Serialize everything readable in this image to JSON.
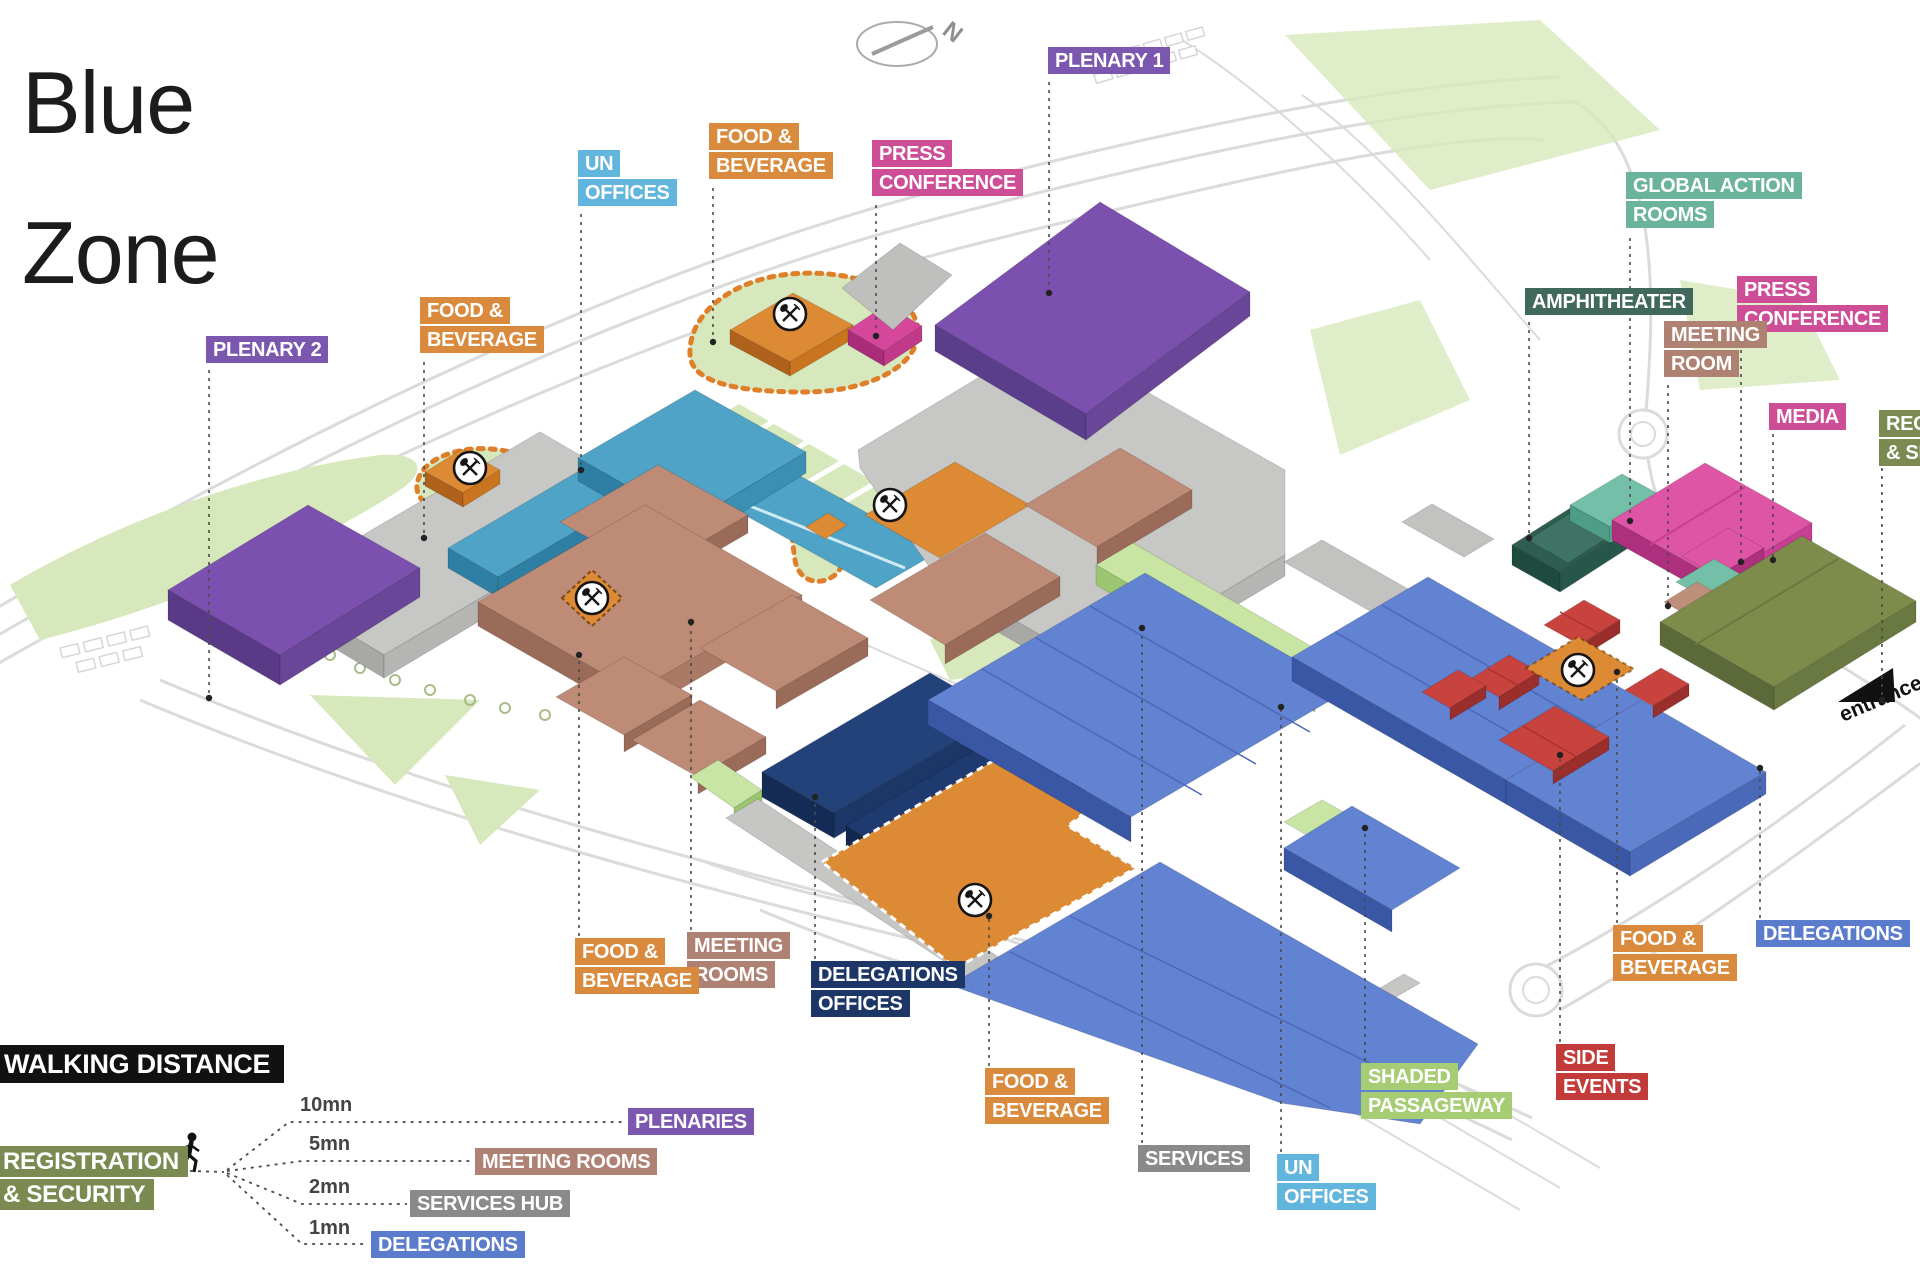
{
  "title": "Blue Zone",
  "map": {
    "compass_n": "N",
    "entrance_label": "entrance"
  },
  "colors": {
    "purple": "#7C57B0",
    "orange": "#D98A3D",
    "pink": "#CE4D97",
    "cyan": "#62B5DC",
    "teal": "#6CB39B",
    "darkgreen": "#40685C",
    "brown": "#AF8173",
    "olive": "#7A8A50",
    "navy": "#1C3667",
    "blue": "#5B7BCC",
    "lightgreen": "#A6CC74",
    "red": "#C23B38",
    "gray": "#8A8A8A",
    "black": "#111111"
  },
  "labels": [
    {
      "id": "plenary-1",
      "lines": [
        "PLENARY 1"
      ],
      "color": "purple",
      "x": 1048,
      "y": 47,
      "leader": {
        "x": 1049,
        "y1": 82,
        "y2": 293
      }
    },
    {
      "id": "un-offices-top",
      "lines": [
        "UN",
        "OFFICES"
      ],
      "color": "cyan",
      "x": 578,
      "y": 150,
      "leader": {
        "x": 581,
        "y1": 214,
        "y2": 470
      }
    },
    {
      "id": "food-beverage-top",
      "lines": [
        "FOOD &",
        "BEVERAGE"
      ],
      "color": "orange",
      "x": 709,
      "y": 123,
      "leader": {
        "x": 713,
        "y1": 188,
        "y2": 342
      }
    },
    {
      "id": "press-conference-top",
      "lines": [
        "PRESS",
        "CONFERENCE"
      ],
      "color": "pink",
      "x": 872,
      "y": 140,
      "leader": {
        "x": 876,
        "y1": 205,
        "y2": 336
      }
    },
    {
      "id": "food-beverage-left",
      "lines": [
        "FOOD &",
        "BEVERAGE"
      ],
      "color": "orange",
      "x": 420,
      "y": 297,
      "leader": {
        "x": 424,
        "y1": 362,
        "y2": 538
      }
    },
    {
      "id": "plenary-2",
      "lines": [
        "PLENARY 2"
      ],
      "color": "purple",
      "x": 206,
      "y": 336,
      "leader": {
        "x": 209,
        "y1": 370,
        "y2": 698
      }
    },
    {
      "id": "global-action-rooms",
      "lines": [
        "GLOBAL ACTION",
        "ROOMS"
      ],
      "color": "teal",
      "x": 1626,
      "y": 172,
      "leader": {
        "x": 1630,
        "y1": 238,
        "y2": 521
      }
    },
    {
      "id": "amphitheater",
      "lines": [
        "AMPHITHEATER"
      ],
      "color": "darkgreen",
      "x": 1525,
      "y": 288,
      "leader": {
        "x": 1529,
        "y1": 322,
        "y2": 538
      }
    },
    {
      "id": "press-conference-right",
      "lines": [
        "PRESS",
        "CONFERENCE"
      ],
      "color": "pink",
      "x": 1737,
      "y": 276,
      "leader": {
        "x": 1741,
        "y1": 342,
        "y2": 562
      }
    },
    {
      "id": "meeting-room-right",
      "lines": [
        "MEETING",
        "ROOM"
      ],
      "color": "brown",
      "x": 1664,
      "y": 321,
      "leader": {
        "x": 1668,
        "y1": 385,
        "y2": 606
      }
    },
    {
      "id": "media",
      "lines": [
        "MEDIA"
      ],
      "color": "pink",
      "x": 1769,
      "y": 403,
      "leader": {
        "x": 1773,
        "y1": 434,
        "y2": 560
      }
    },
    {
      "id": "registration-security-right",
      "lines": [
        "REGISTRATION",
        "& SECURITY"
      ],
      "color": "olive",
      "x": 1879,
      "y": 410,
      "leader": {
        "x": 1882,
        "y1": 468,
        "y2": 700
      }
    },
    {
      "id": "meeting-rooms-bottom",
      "lines": [
        "MEETING",
        "ROOMS"
      ],
      "color": "brown",
      "x": 687,
      "y": 932,
      "leader": {
        "x": 691,
        "y1": 930,
        "y2": 622
      }
    },
    {
      "id": "food-beverage-bottom-left",
      "lines": [
        "FOOD &",
        "BEVERAGE"
      ],
      "color": "orange",
      "x": 575,
      "y": 938,
      "leader": {
        "x": 579,
        "y1": 936,
        "y2": 655
      }
    },
    {
      "id": "delegations-offices",
      "lines": [
        "DELEGATIONS",
        "OFFICES"
      ],
      "color": "navy",
      "x": 811,
      "y": 961,
      "leader": {
        "x": 815,
        "y1": 959,
        "y2": 797
      }
    },
    {
      "id": "food-beverage-bottom-center",
      "lines": [
        "FOOD &",
        "BEVERAGE"
      ],
      "color": "orange",
      "x": 985,
      "y": 1068,
      "leader": {
        "x": 989,
        "y1": 1066,
        "y2": 916
      }
    },
    {
      "id": "services",
      "lines": [
        "SERVICES"
      ],
      "color": "gray",
      "x": 1138,
      "y": 1145,
      "leader": {
        "x": 1142,
        "y1": 1143,
        "y2": 628
      }
    },
    {
      "id": "un-offices-bottom",
      "lines": [
        "UN",
        "OFFICES"
      ],
      "color": "cyan",
      "x": 1277,
      "y": 1154,
      "leader": {
        "x": 1281,
        "y1": 1152,
        "y2": 707
      }
    },
    {
      "id": "shaded-passageway",
      "lines": [
        "SHADED",
        "PASSAGEWAY"
      ],
      "color": "lightgreen",
      "x": 1361,
      "y": 1063,
      "leader": {
        "x": 1365,
        "y1": 1061,
        "y2": 828
      }
    },
    {
      "id": "side-events",
      "lines": [
        "SIDE",
        "EVENTS"
      ],
      "color": "red",
      "x": 1556,
      "y": 1044,
      "leader": {
        "x": 1560,
        "y1": 1042,
        "y2": 755
      }
    },
    {
      "id": "food-beverage-right",
      "lines": [
        "FOOD &",
        "BEVERAGE"
      ],
      "color": "orange",
      "x": 1613,
      "y": 925,
      "leader": {
        "x": 1617,
        "y1": 923,
        "y2": 672
      }
    },
    {
      "id": "delegations-right",
      "lines": [
        "DELEGATIONS"
      ],
      "color": "blue",
      "x": 1756,
      "y": 920,
      "leader": {
        "x": 1760,
        "y1": 918,
        "y2": 768
      }
    }
  ],
  "legend": {
    "title": "WALKING DISTANCE",
    "origin_lines": [
      "REGISTRATION",
      "& SECURITY"
    ],
    "origin_color": "olive",
    "origin_line_points": "158,1170 224,1172",
    "items": [
      {
        "time": "10mn",
        "label": "PLENARIES",
        "color": "purple",
        "time_x": 300,
        "time_y": 1094,
        "chip_x": 628,
        "chip_y": 1108,
        "line": "227,1170 289,1122 626,1122"
      },
      {
        "time": "5mn",
        "label": "MEETING ROOMS",
        "color": "brown",
        "time_x": 309,
        "time_y": 1133,
        "chip_x": 475,
        "chip_y": 1148,
        "line": "227,1171 302,1161 472,1161"
      },
      {
        "time": "2mn",
        "label": "SERVICES HUB",
        "color": "gray",
        "time_x": 309,
        "time_y": 1176,
        "chip_x": 410,
        "chip_y": 1190,
        "line": "227,1173 302,1204 407,1204"
      },
      {
        "time": "1mn",
        "label": "DELEGATIONS",
        "color": "blue",
        "time_x": 309,
        "time_y": 1217,
        "chip_x": 371,
        "chip_y": 1231,
        "line": "227,1175 302,1244 368,1244"
      }
    ]
  }
}
